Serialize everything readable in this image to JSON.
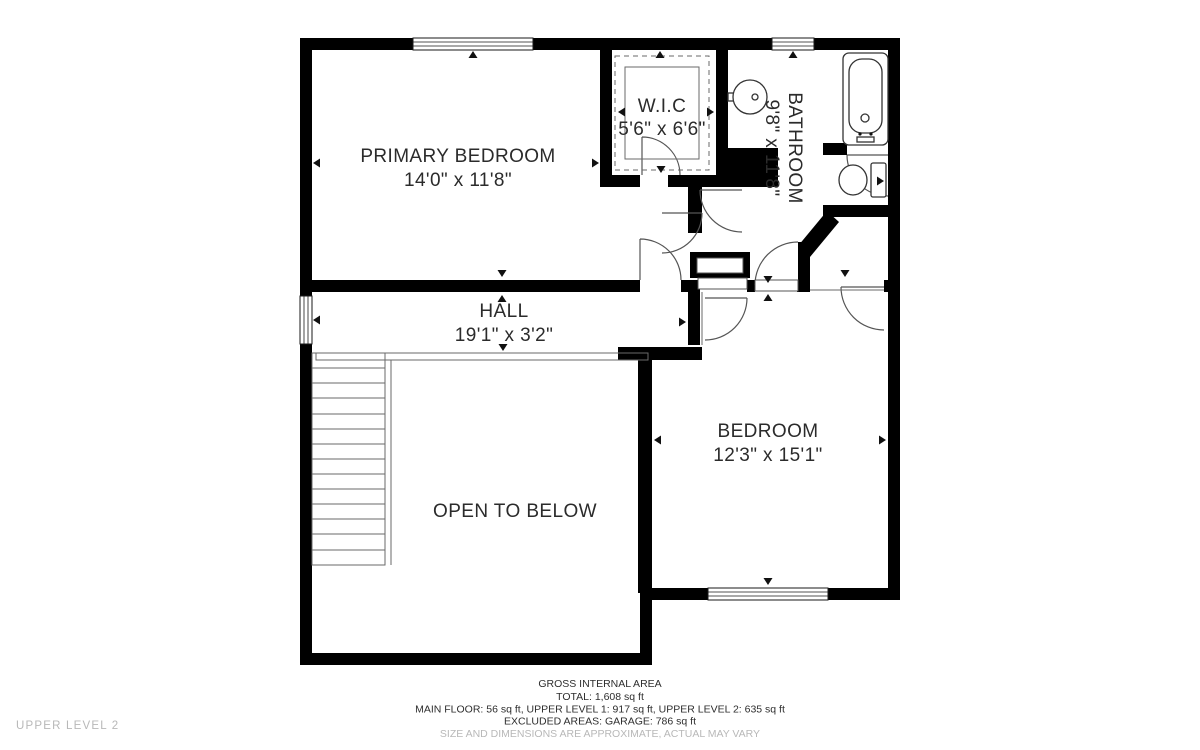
{
  "floor_label": "UPPER LEVEL 2",
  "rooms": {
    "primary_bedroom": {
      "name": "PRIMARY BEDROOM",
      "dims": "14'0\" x 11'8\""
    },
    "wic": {
      "name": "W.I.C",
      "dims": "5'6\" x 6'6\""
    },
    "bathroom": {
      "name": "BATHROOM",
      "dims": "9'8\" x 11'8\""
    },
    "hall": {
      "name": "HALL",
      "dims": "19'1\" x 3'2\""
    },
    "bedroom": {
      "name": "BEDROOM",
      "dims": "12'3\" x 15'1\""
    },
    "open_to_below": {
      "name": "OPEN TO BELOW"
    }
  },
  "footer": {
    "title": "GROSS INTERNAL AREA",
    "total": "TOTAL: 1,608 sq ft",
    "breakdown": "MAIN FLOOR: 56 sq ft, UPPER LEVEL 1: 917 sq ft, UPPER LEVEL 2: 635 sq ft",
    "excluded": "EXCLUDED AREAS: GARAGE: 786 sq ft",
    "disclaimer": "SIZE AND DIMENSIONS ARE APPROXIMATE, ACTUAL MAY VARY"
  },
  "colors": {
    "wall": "#000000",
    "line": "#555555",
    "text": "#2b2b2b",
    "muted": "#b8b8b8"
  }
}
